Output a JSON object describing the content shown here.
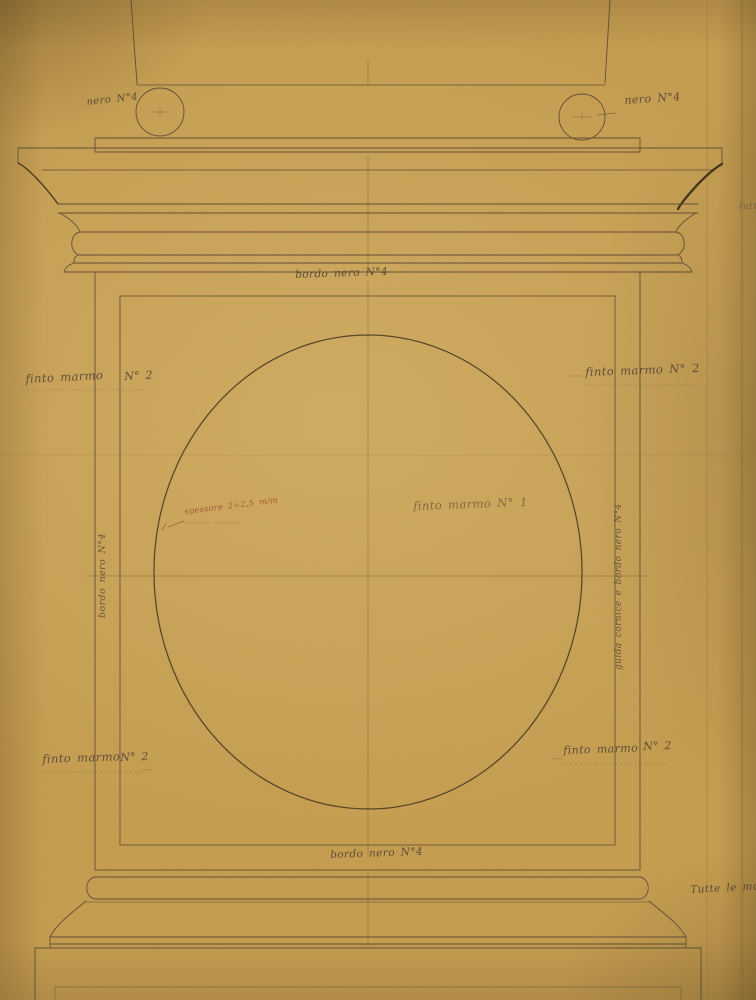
{
  "labels": {
    "nero_left": "nero N°4",
    "nero_right": "nero N°4",
    "bordo_top": "bordo nero N°4",
    "finto_marmo_top_left": "finto marmo",
    "num_top_left": "N° 2",
    "finto_marmo_top_right": "finto marmo N° 2",
    "finto_marmo_center": "finto marmo N° 1",
    "spessore_note": "spessore 2÷2,5 m/m",
    "bordo_left_vertical": "bordo nero N°4",
    "guida_right_vertical": "guida cornice e bordo nero N°4",
    "finto_marmo_bottom_left": "finto marmo",
    "num_bottom_left": "N° 2",
    "finto_marmo_bottom_right": "finto marmo",
    "num_bottom_right": "N° 2",
    "bordo_bottom": "bordo nero N°4",
    "edge_note_right": "tutt",
    "corner_note": "Tutte le modane"
  },
  "colors": {
    "paper": "#c69e52",
    "ink": "#4f4230",
    "ink_dark": "#271d11",
    "text_ink": "#554738",
    "faded_ink": "#7d6342",
    "red_note": "#9c4a2c"
  }
}
